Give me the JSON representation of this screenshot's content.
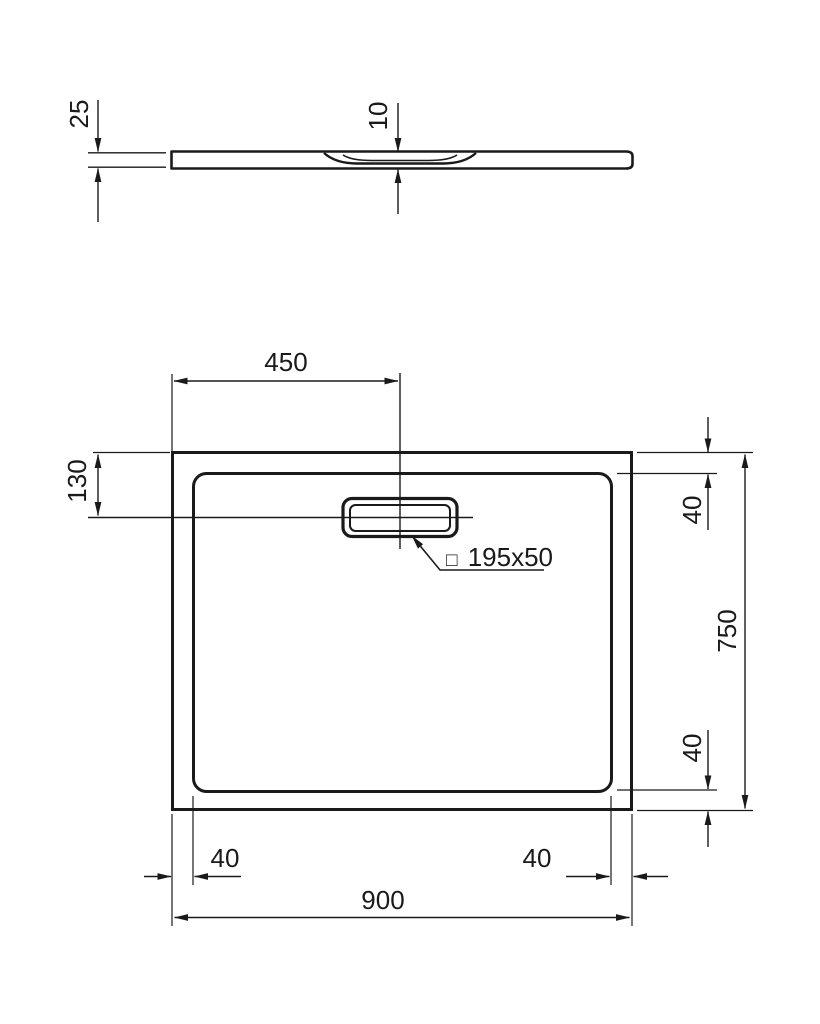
{
  "style": {
    "ink": "#1a1a1a",
    "background": "#ffffff"
  },
  "side_view": {
    "overall_height_label": "25",
    "drain_recess_depth_label": "10"
  },
  "plan_view": {
    "drain_center_from_left_label": "450",
    "drain_center_from_top_label": "130",
    "drain_cutout_symbol": "□",
    "drain_cutout_size_label": "195x50",
    "rim_inset_top_label": "40",
    "overall_depth_label": "750",
    "rim_inset_bottom_label": "40",
    "rim_inset_left_label": "40",
    "rim_inset_right_label": "40",
    "overall_width_label": "900"
  }
}
